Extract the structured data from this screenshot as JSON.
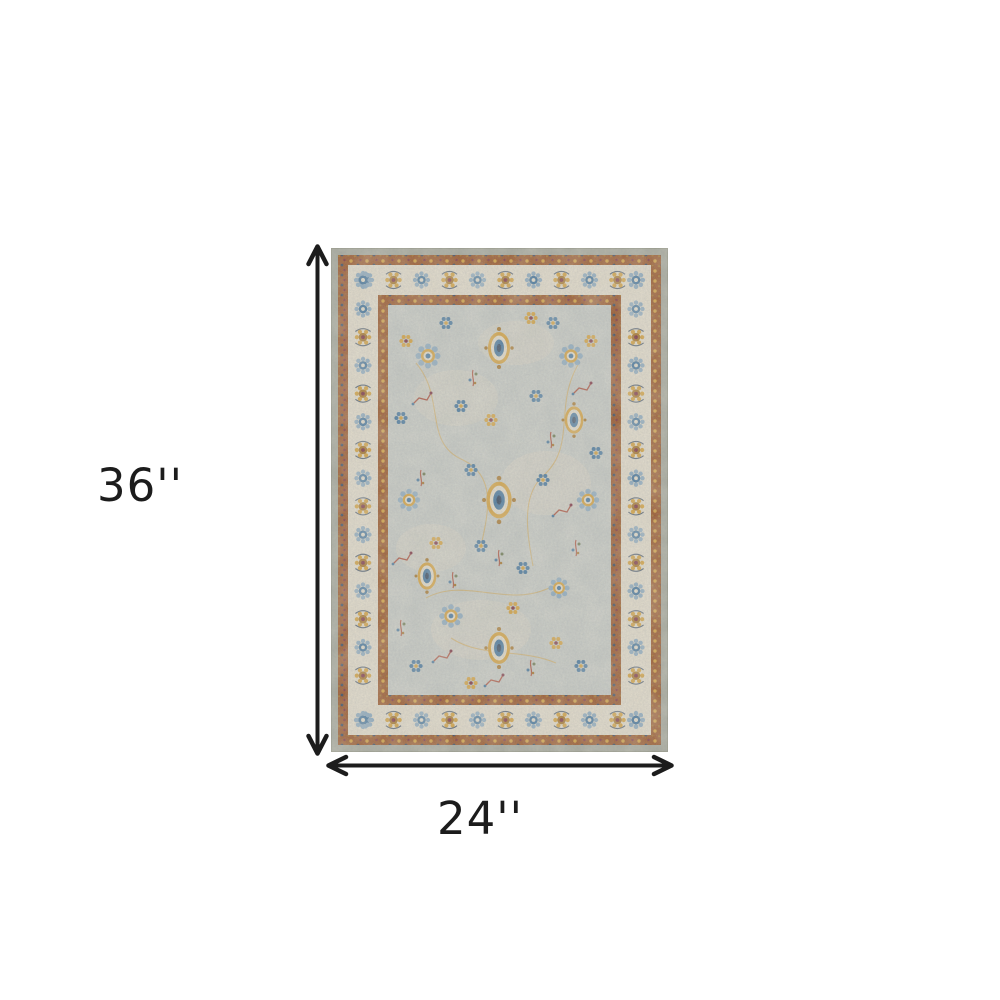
{
  "page": {
    "background_color": "#ffffff"
  },
  "figure": {
    "height_label": "36''",
    "width_label": "24''",
    "annotation_color": "#1c1c1c"
  },
  "rug": {
    "description": "Gray ivory and orange vintage oriental area rug with multicolor floral pattern",
    "palette": {
      "edge_sage": "#a7aa9d",
      "edge_line": "#8f927f",
      "border_rust": "#9b5425",
      "band_ivory": "#e6dfcd",
      "field_gray": "#c8ccc6",
      "ivory_worn": "#ded8c6",
      "blue": "#47789f",
      "light_blue": "#8fadc2",
      "navy": "#364960",
      "gold": "#d8a33c",
      "dark_gold": "#a8762a",
      "maroon": "#7c3040",
      "red_stem": "#b05541",
      "green": "#6d7b51"
    }
  }
}
